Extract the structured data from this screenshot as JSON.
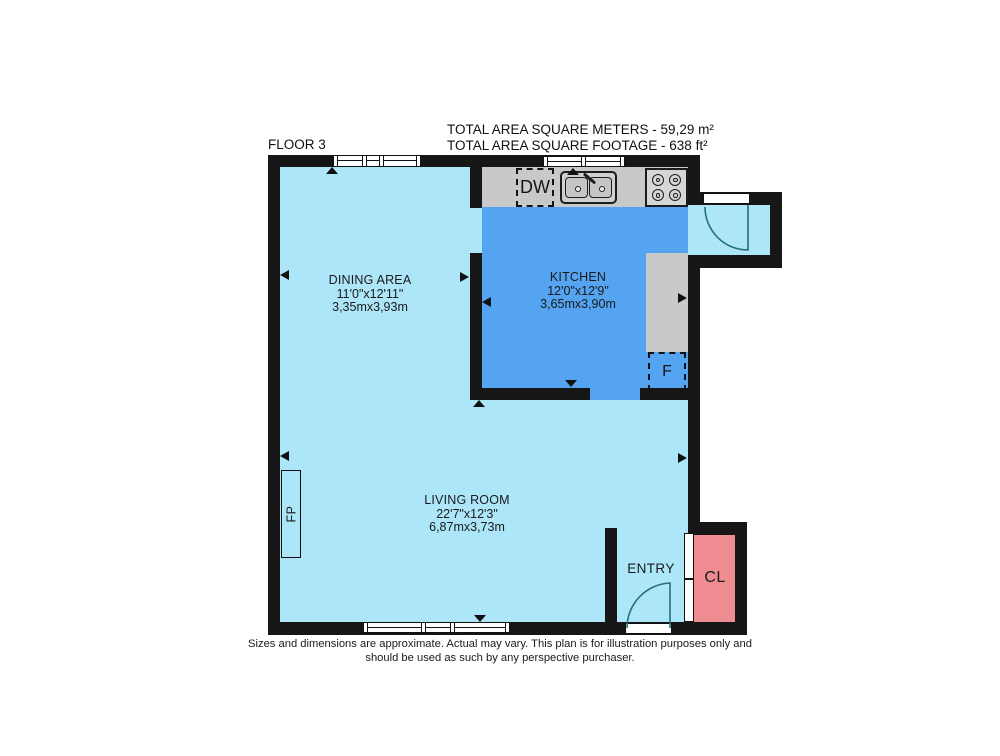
{
  "header": {
    "floor_label": "FLOOR 3",
    "total_m2": "TOTAL AREA SQUARE METERS - 59,29 m²",
    "total_ft2": "TOTAL AREA SQUARE FOOTAGE - 638 ft²"
  },
  "rooms": {
    "dining": {
      "name": "DINING AREA",
      "dims_ft": "11'0\"x12'11\"",
      "dims_m": "3,35mx3,93m"
    },
    "kitchen": {
      "name": "KITCHEN",
      "dims_ft": "12'0\"x12'9\"",
      "dims_m": "3,65mx3,90m"
    },
    "living": {
      "name": "LIVING ROOM",
      "dims_ft": "22'7\"x12'3\"",
      "dims_m": "6,87mx3,73m"
    },
    "entry": {
      "name": "ENTRY"
    },
    "closet": {
      "label": "CL"
    }
  },
  "fixtures": {
    "dishwasher_label": "DW",
    "fridge_label": "F",
    "fireplace_label": "FP"
  },
  "disclaimer": {
    "line1": "Sizes and dimensions are approximate. Actual may vary. This plan is for illustration purposes only and",
    "line2": "should be used as such by any perspective purchaser."
  },
  "colors": {
    "floor_light": "#ace6f8",
    "kitchen_blue": "#54a4f1",
    "counter_gray": "#c9c9c9",
    "closet_pink": "#ee8c92",
    "wall_black": "#161616",
    "door_arc": "#26707d"
  }
}
